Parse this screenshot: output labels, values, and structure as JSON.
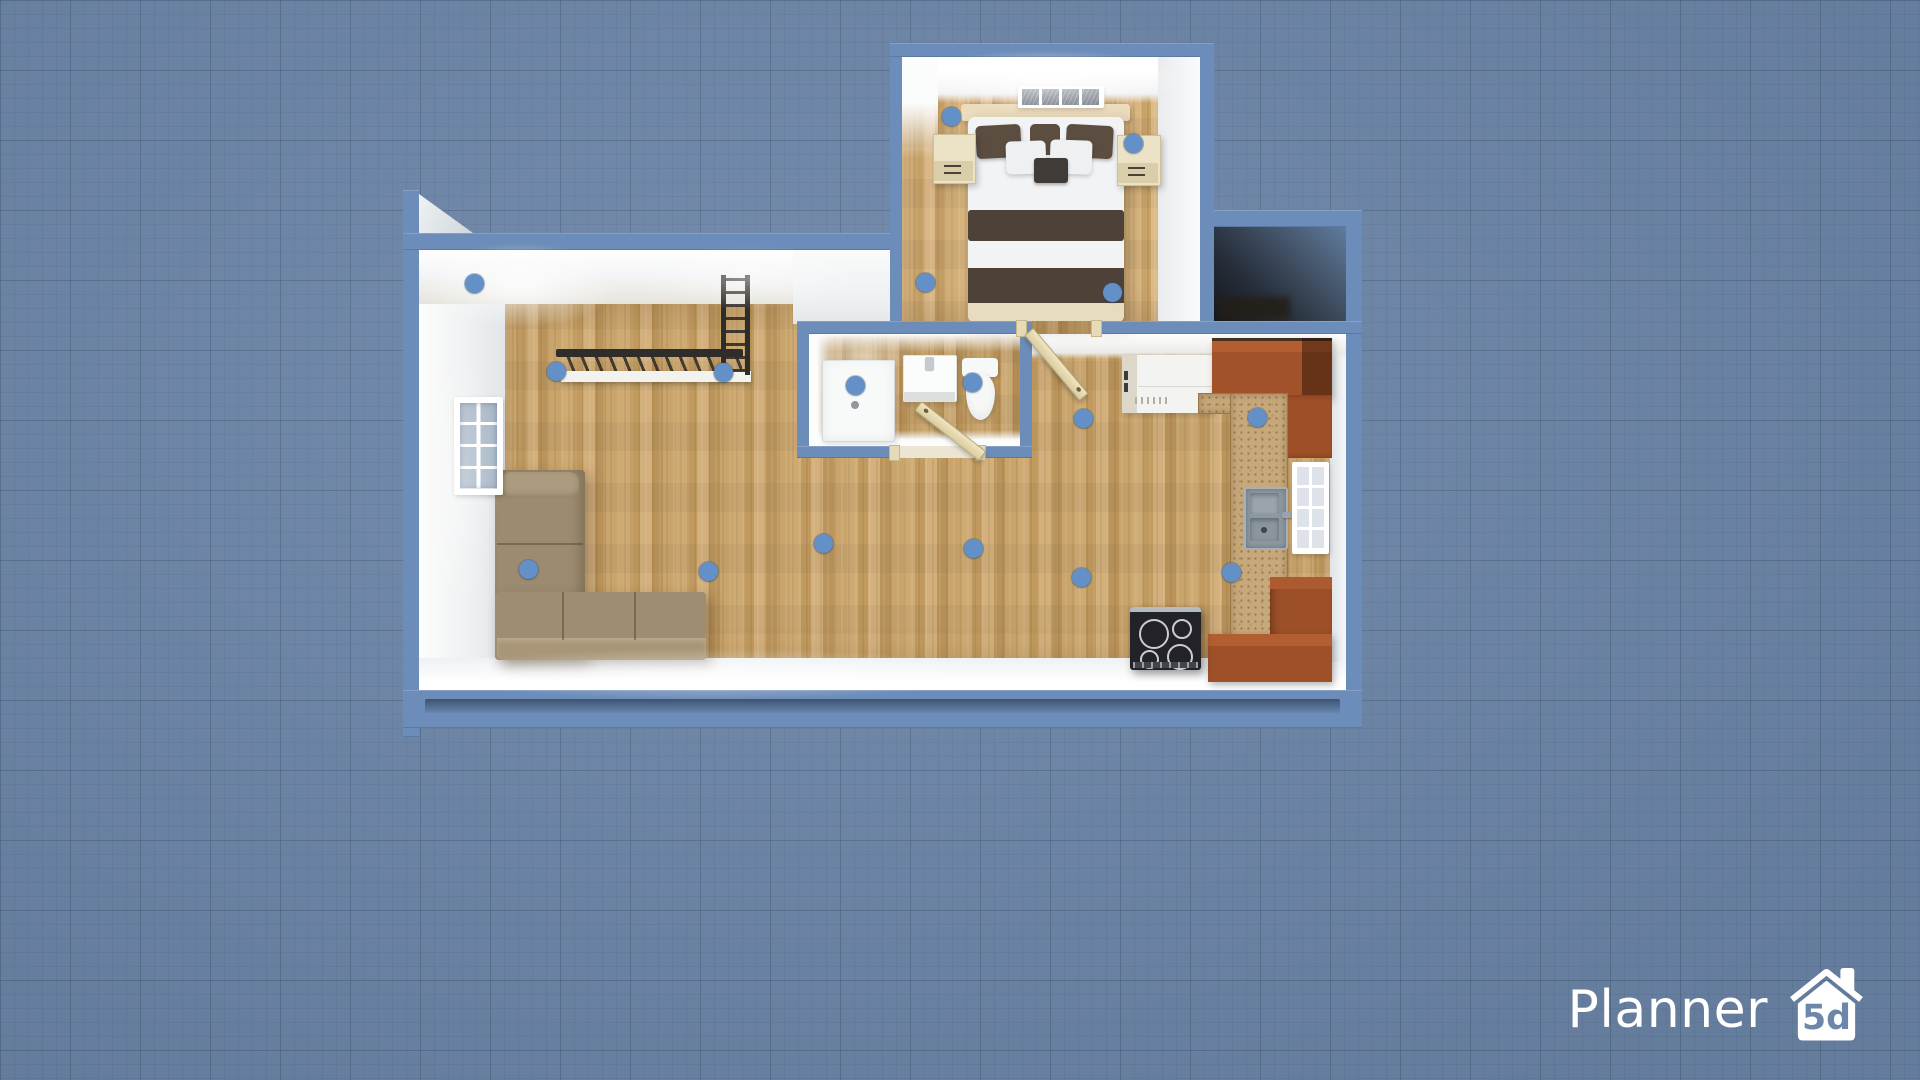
{
  "app": {
    "name": "Planner 5D",
    "view": "3d-floor-plan-top-down"
  },
  "logo": {
    "brand": "Planner",
    "badge": "5d"
  },
  "canvas": {
    "background_color": "#6e87a9",
    "grid": {
      "major_px": 70,
      "minor_px": 14
    }
  },
  "palette": {
    "wall_cut": "#6c8db9",
    "wall_inner_face": "#f2f4f5",
    "floor_wood": "#c7a268",
    "kitchen_cabinet": "#a1522a",
    "countertop_speckled": "#c6a87a",
    "sofa": "#9c8b70",
    "bed_stripe": "#4e4138",
    "marker": "#6390c6",
    "logo_text": "#ffffff"
  },
  "rooms": [
    {
      "name": "bedroom",
      "objects": [
        "double-bed",
        "nightstand-left",
        "nightstand-right",
        "window"
      ]
    },
    {
      "name": "bathroom",
      "objects": [
        "shower",
        "sink-vanity",
        "toilet",
        "door"
      ]
    },
    {
      "name": "living-room",
      "objects": [
        "corner-sofa",
        "wall-rack",
        "ladder-rail",
        "shelf",
        "window"
      ]
    },
    {
      "name": "kitchen",
      "objects": [
        "fridge-counter",
        "corner-cabinets",
        "sink",
        "cooktop",
        "window"
      ]
    },
    {
      "name": "closet",
      "objects": []
    }
  ],
  "markers": [
    {
      "x": 951,
      "y": 116
    },
    {
      "x": 1133,
      "y": 143
    },
    {
      "x": 925,
      "y": 282
    },
    {
      "x": 1112,
      "y": 292
    },
    {
      "x": 474,
      "y": 283
    },
    {
      "x": 556,
      "y": 371
    },
    {
      "x": 723,
      "y": 372
    },
    {
      "x": 855,
      "y": 385
    },
    {
      "x": 972,
      "y": 382
    },
    {
      "x": 1083,
      "y": 418
    },
    {
      "x": 1257,
      "y": 417
    },
    {
      "x": 528,
      "y": 569
    },
    {
      "x": 708,
      "y": 571
    },
    {
      "x": 823,
      "y": 543
    },
    {
      "x": 973,
      "y": 548
    },
    {
      "x": 1081,
      "y": 577
    },
    {
      "x": 1231,
      "y": 572
    }
  ]
}
